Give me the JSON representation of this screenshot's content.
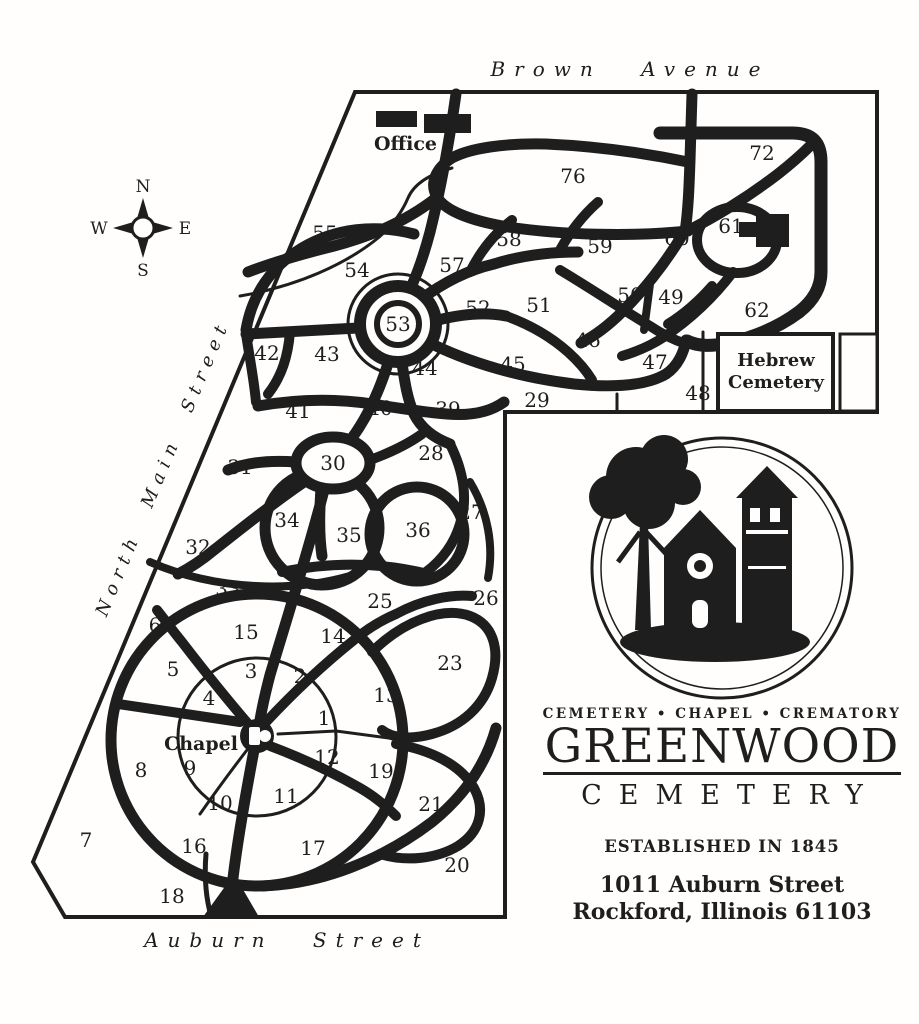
{
  "colors": {
    "ink": "#1e1e1e",
    "paper": "#fffefc"
  },
  "map": {
    "streets": {
      "top": "Brown Avenue",
      "left": "North Main Street",
      "bottom": "Auburn Street"
    },
    "compass": {
      "north": "N",
      "south": "S",
      "east": "E",
      "west": "W"
    },
    "office_label": "Office",
    "chapel_label": "Chapel",
    "hebrew_line1": "Hebrew",
    "hebrew_line2": "Cemetery",
    "sections": [
      {
        "label": "76",
        "x": 573,
        "y": 183
      },
      {
        "label": "72",
        "x": 762,
        "y": 160
      },
      {
        "label": "55",
        "x": 325,
        "y": 240
      },
      {
        "label": "54",
        "x": 357,
        "y": 277
      },
      {
        "label": "57",
        "x": 452,
        "y": 272
      },
      {
        "label": "58",
        "x": 509,
        "y": 246
      },
      {
        "label": "59",
        "x": 600,
        "y": 253
      },
      {
        "label": "60",
        "x": 677,
        "y": 245
      },
      {
        "label": "61",
        "x": 731,
        "y": 233
      },
      {
        "label": "53",
        "x": 398,
        "y": 331
      },
      {
        "label": "52",
        "x": 478,
        "y": 315
      },
      {
        "label": "51",
        "x": 539,
        "y": 312
      },
      {
        "label": "50",
        "x": 630,
        "y": 302
      },
      {
        "label": "49",
        "x": 671,
        "y": 304
      },
      {
        "label": "46",
        "x": 588,
        "y": 347
      },
      {
        "label": "62",
        "x": 757,
        "y": 317
      },
      {
        "label": "42",
        "x": 267,
        "y": 360
      },
      {
        "label": "43",
        "x": 327,
        "y": 361
      },
      {
        "label": "44",
        "x": 425,
        "y": 375
      },
      {
        "label": "45",
        "x": 513,
        "y": 371
      },
      {
        "label": "47",
        "x": 655,
        "y": 369
      },
      {
        "label": "48",
        "x": 698,
        "y": 400
      },
      {
        "label": "41",
        "x": 298,
        "y": 418
      },
      {
        "label": "40",
        "x": 380,
        "y": 415
      },
      {
        "label": "39",
        "x": 448,
        "y": 416
      },
      {
        "label": "29",
        "x": 537,
        "y": 407
      },
      {
        "label": "31",
        "x": 240,
        "y": 474
      },
      {
        "label": "30",
        "x": 333,
        "y": 470
      },
      {
        "label": "28",
        "x": 431,
        "y": 460
      },
      {
        "label": "34",
        "x": 287,
        "y": 527
      },
      {
        "label": "35",
        "x": 349,
        "y": 542
      },
      {
        "label": "36",
        "x": 418,
        "y": 537
      },
      {
        "label": "27",
        "x": 471,
        "y": 519
      },
      {
        "label": "32",
        "x": 198,
        "y": 554
      },
      {
        "label": "33",
        "x": 228,
        "y": 596
      },
      {
        "label": "25",
        "x": 380,
        "y": 608
      },
      {
        "label": "26",
        "x": 486,
        "y": 605
      },
      {
        "label": "6",
        "x": 155,
        "y": 632
      },
      {
        "label": "15",
        "x": 246,
        "y": 639
      },
      {
        "label": "14",
        "x": 333,
        "y": 643
      },
      {
        "label": "5",
        "x": 173,
        "y": 676
      },
      {
        "label": "3",
        "x": 251,
        "y": 678
      },
      {
        "label": "2",
        "x": 300,
        "y": 683
      },
      {
        "label": "23",
        "x": 450,
        "y": 670
      },
      {
        "label": "4",
        "x": 209,
        "y": 705
      },
      {
        "label": "13",
        "x": 386,
        "y": 702
      },
      {
        "label": "1",
        "x": 324,
        "y": 725
      },
      {
        "label": "12",
        "x": 327,
        "y": 764
      },
      {
        "label": "8",
        "x": 141,
        "y": 777
      },
      {
        "label": "9",
        "x": 190,
        "y": 775
      },
      {
        "label": "19",
        "x": 381,
        "y": 778
      },
      {
        "label": "10",
        "x": 220,
        "y": 810
      },
      {
        "label": "11",
        "x": 286,
        "y": 803
      },
      {
        "label": "21",
        "x": 431,
        "y": 811
      },
      {
        "label": "7",
        "x": 86,
        "y": 847
      },
      {
        "label": "16",
        "x": 194,
        "y": 853
      },
      {
        "label": "17",
        "x": 313,
        "y": 855
      },
      {
        "label": "20",
        "x": 457,
        "y": 872
      },
      {
        "label": "18",
        "x": 172,
        "y": 903
      }
    ]
  },
  "brand": {
    "tagline": "CEMETERY • CHAPEL • CREMATORY",
    "name": "GREENWOOD",
    "sub": "CEMETERY",
    "established": "ESTABLISHED IN 1845",
    "address1": "1011 Auburn Street",
    "address2": "Rockford, Illinois 61103"
  }
}
